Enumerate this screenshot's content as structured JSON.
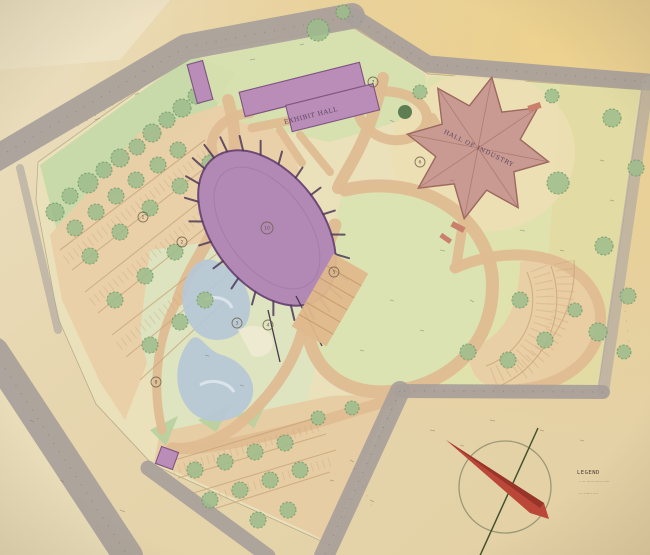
{
  "labels": {
    "exhibit_hall": "EXHIBIT HALL",
    "star_hall": "HALL OF INDUSTRY",
    "oval_keynote": "10"
  },
  "legend": {
    "title": "LEGEND",
    "line1": "· ··· ····· ······ ·····",
    "line2": "··· ······ ····"
  },
  "street_marks": {
    "northwest_road": "· · · · · ·",
    "northeast_road": "· · · ·",
    "east_road": "· · · · ·",
    "south_road": "· · · · ·"
  },
  "keynotes": [
    "1",
    "2",
    "3",
    "4",
    "5",
    "6",
    "7",
    "8"
  ],
  "colors": {
    "paper": "#e6d5ad",
    "paper_gold": "#e9ce92",
    "road_gray": "#a8a09a",
    "lawn_green": "#d8dfb2",
    "grove_green": "#c5d9a8",
    "walk_tan": "#dfbc92",
    "parking_tan": "#e9cfa6",
    "building_purple": "#b98db8",
    "star_pink": "#c89a92",
    "pond_blue": "#b6c7d7",
    "tree_green": "#9dbd8c",
    "compass_red": "#bb4638"
  }
}
